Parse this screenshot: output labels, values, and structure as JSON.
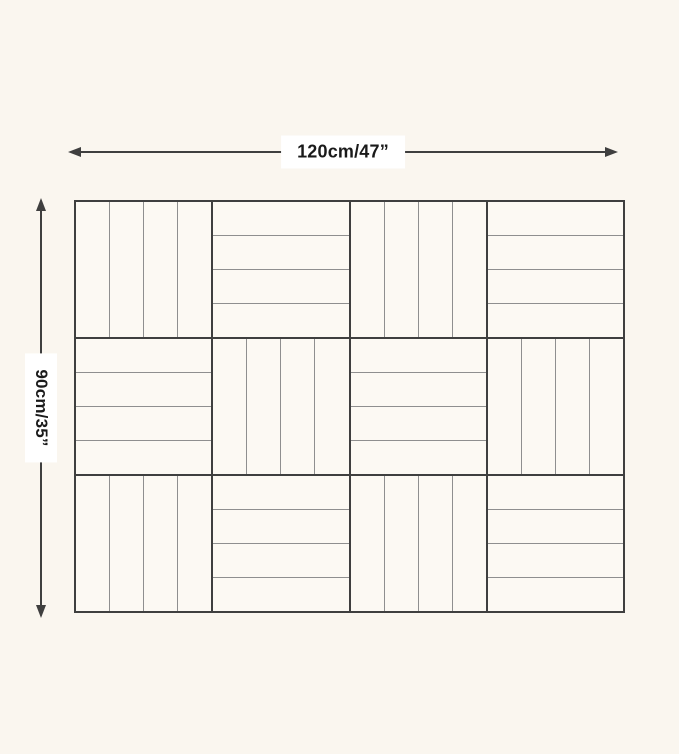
{
  "page": {
    "background": "#faf6ef"
  },
  "colors": {
    "line_dark": "#3f3f3f",
    "plank_line": "#8f8f8f",
    "tile_fill": "#fcf9f3",
    "label_bg": "#ffffff",
    "label_text": "#1a1a1a"
  },
  "dimensions": {
    "width_label": "120cm/47”",
    "height_label": "90cm/35”"
  },
  "tile_grid": {
    "rows": 3,
    "cols": 4,
    "planks_per_tile": 4,
    "orientations": [
      [
        "vertical",
        "horizontal",
        "vertical",
        "horizontal"
      ],
      [
        "horizontal",
        "vertical",
        "horizontal",
        "vertical"
      ],
      [
        "vertical",
        "horizontal",
        "vertical",
        "horizontal"
      ]
    ]
  }
}
